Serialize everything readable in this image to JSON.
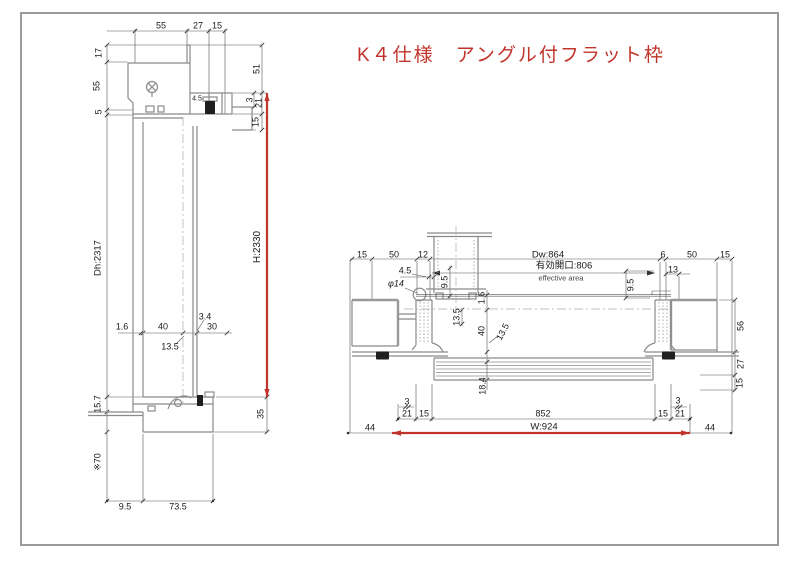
{
  "title": "K４仕様　アングル付フラット枠",
  "colors": {
    "accent": "#c2342b",
    "line": "#8a8a8a",
    "dim": "#1a1a1a",
    "border": "#9a9a9a"
  },
  "left_view": {
    "labels": [
      {
        "t": "55",
        "x": 161,
        "y": 26
      },
      {
        "t": "27",
        "x": 198,
        "y": 26
      },
      {
        "t": "15",
        "x": 217,
        "y": 26
      },
      {
        "t": "17",
        "x": 99,
        "y": 53,
        "r": -90
      },
      {
        "t": "55",
        "x": 97,
        "y": 86,
        "r": -90
      },
      {
        "t": "5",
        "x": 99,
        "y": 112,
        "r": -90
      },
      {
        "t": "Dh:2317",
        "x": 98,
        "y": 258,
        "r": -90,
        "s": 9.5,
        "n": "door-height-label"
      },
      {
        "t": "51",
        "x": 257,
        "y": 69,
        "r": -90
      },
      {
        "t": "3",
        "x": 250,
        "y": 100,
        "r": -90
      },
      {
        "t": "21",
        "x": 259,
        "y": 103,
        "r": -90
      },
      {
        "t": "15",
        "x": 256,
        "y": 122,
        "r": -90
      },
      {
        "t": "4.5",
        "x": 197,
        "y": 99,
        "s": 7
      },
      {
        "t": "H:2330",
        "x": 258,
        "y": 247,
        "r": -90,
        "s": 10,
        "n": "overall-height-label"
      },
      {
        "t": "1.6",
        "x": 122,
        "y": 327
      },
      {
        "t": "40",
        "x": 163,
        "y": 327
      },
      {
        "t": "3.4",
        "x": 205,
        "y": 317
      },
      {
        "t": "30",
        "x": 212,
        "y": 327
      },
      {
        "t": "13.5",
        "x": 170,
        "y": 347
      },
      {
        "t": "35",
        "x": 261,
        "y": 414,
        "r": -90
      },
      {
        "t": "15.7",
        "x": 98,
        "y": 404,
        "r": -90
      },
      {
        "t": "※70",
        "x": 98,
        "y": 462,
        "r": -90
      },
      {
        "t": "9.5",
        "x": 125,
        "y": 507
      },
      {
        "t": "73.5",
        "x": 178,
        "y": 507
      }
    ]
  },
  "right_view": {
    "labels": [
      {
        "t": "15",
        "x": 362,
        "y": 255
      },
      {
        "t": "50",
        "x": 394,
        "y": 255
      },
      {
        "t": "12",
        "x": 423,
        "y": 255
      },
      {
        "t": "4.5",
        "x": 405,
        "y": 271
      },
      {
        "t": "φ14",
        "x": 396,
        "y": 284,
        "i": 1
      },
      {
        "t": "9.5",
        "x": 445,
        "y": 282,
        "r": -90
      },
      {
        "t": "Dw:864",
        "x": 548,
        "y": 255,
        "s": 9.5,
        "n": "door-width-label"
      },
      {
        "t": "有効開口:806",
        "x": 564,
        "y": 266,
        "s": 9.5,
        "n": "effective-opening-label"
      },
      {
        "t": "effective area",
        "x": 561,
        "y": 278,
        "s": 7.5,
        "c": "#444",
        "n": "effective-area-label"
      },
      {
        "t": "1.6",
        "x": 482,
        "y": 298,
        "r": -90
      },
      {
        "t": "13.5",
        "x": 457,
        "y": 317,
        "r": -90
      },
      {
        "t": "40",
        "x": 482,
        "y": 331,
        "r": -90
      },
      {
        "t": "13.5",
        "x": 503,
        "y": 332,
        "r": -62
      },
      {
        "t": "18.4",
        "x": 483,
        "y": 386,
        "r": -90
      },
      {
        "t": "6",
        "x": 663,
        "y": 255
      },
      {
        "t": "50",
        "x": 692,
        "y": 255
      },
      {
        "t": "15",
        "x": 725,
        "y": 255
      },
      {
        "t": "13",
        "x": 673,
        "y": 270
      },
      {
        "t": "9.5",
        "x": 631,
        "y": 285,
        "r": -90
      },
      {
        "t": "56",
        "x": 741,
        "y": 326,
        "r": -90
      },
      {
        "t": "27",
        "x": 741,
        "y": 364,
        "r": -90
      },
      {
        "t": "15",
        "x": 740,
        "y": 383,
        "r": -90
      },
      {
        "t": "3",
        "x": 407,
        "y": 402
      },
      {
        "t": "21",
        "x": 407,
        "y": 414
      },
      {
        "t": "15",
        "x": 424,
        "y": 414
      },
      {
        "t": "852",
        "x": 543,
        "y": 414
      },
      {
        "t": "15",
        "x": 663,
        "y": 414
      },
      {
        "t": "21",
        "x": 680,
        "y": 414
      },
      {
        "t": "3",
        "x": 678,
        "y": 401
      },
      {
        "t": "W:924",
        "x": 544,
        "y": 427,
        "s": 9.5,
        "n": "overall-width-label"
      },
      {
        "t": "44",
        "x": 370,
        "y": 428
      },
      {
        "t": "44",
        "x": 710,
        "y": 428
      }
    ]
  }
}
